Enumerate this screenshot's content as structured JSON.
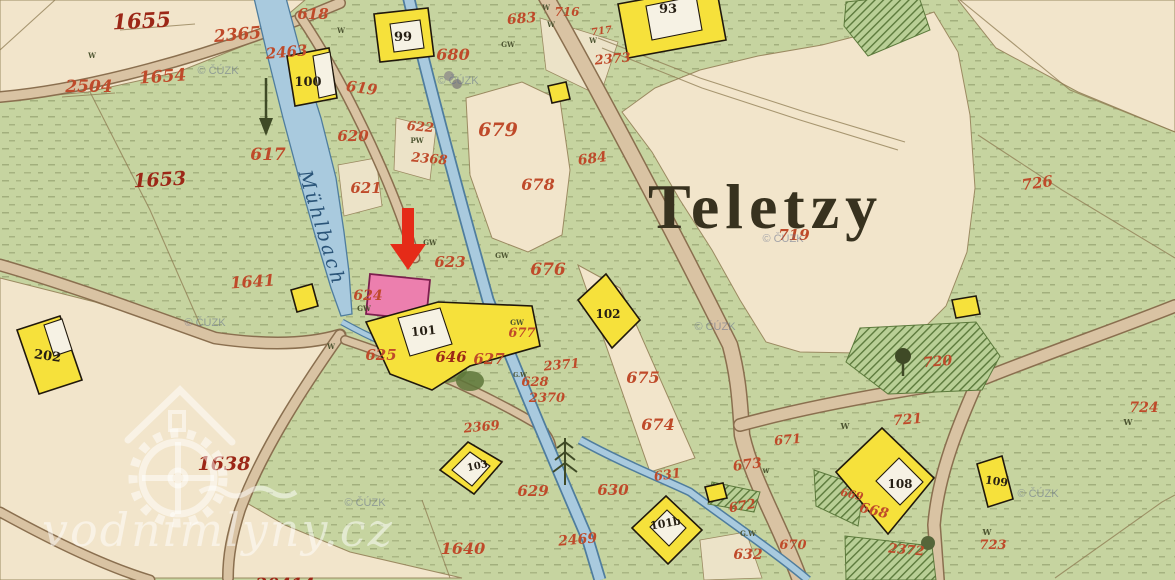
{
  "map": {
    "place_title": "Teletzy",
    "stream_name": "Mühlbach"
  },
  "watermarks": {
    "copyright": "© ČÚZK",
    "site": "vodnimlyny.cz"
  },
  "parcels": {
    "p1655": "1655",
    "p2365": "2365",
    "p2463": "2463",
    "p2504": "2504",
    "p1654": "1654",
    "p1653": "1653",
    "p617": "617",
    "p1641": "1641",
    "p618": "618",
    "p619": "619",
    "p620": "620",
    "p621": "621",
    "p622": "622",
    "p2368": "2368",
    "p623": "623",
    "p624": "624",
    "p625": "625",
    "p646": "646",
    "p627": "627",
    "p628": "628",
    "p2371": "2371",
    "p2370": "2370",
    "p2369": "2369",
    "p679": "679",
    "p680": "680",
    "p683": "683",
    "p716": "716",
    "p717": "717",
    "p2373": "2373",
    "p684": "684",
    "p678": "678",
    "p676": "676",
    "p677": "677",
    "p675": "675",
    "p674": "674",
    "p673": "673",
    "p671": "671",
    "p631": "631",
    "p630": "630",
    "p629": "629",
    "p2469": "2469",
    "p1640": "1640",
    "p632": "632",
    "p670": "670",
    "p672": "672",
    "p668": "668",
    "p669": "669",
    "p2372": "2372",
    "p719": "719",
    "p726": "726",
    "p720": "720",
    "p721": "721",
    "p724": "724",
    "p723": "723",
    "p1638": "1638",
    "p20414": "20414"
  },
  "houses": {
    "h93": "93",
    "h99": "99",
    "h100": "100",
    "h101": "101",
    "h101b": "101b",
    "h102": "102",
    "h103": "103",
    "h108": "108",
    "h109": "109",
    "h202": "202"
  },
  "marks": {
    "w": "W",
    "w_lower": "w",
    "gw": "GW",
    "gw_dot": "G.W",
    "pw": "PW"
  },
  "colors": {
    "meadow_green": "#c6d4a0",
    "field_cream": "#f2e5cb",
    "road_tan": "#d9c3a3",
    "stream_blue": "#a9cade",
    "building_yellow": "#f6e13b",
    "mill_pink": "#ec7fae",
    "label_red": "#bf4a2a",
    "arrow_red": "#e52b18",
    "title_ink": "#38321f"
  }
}
